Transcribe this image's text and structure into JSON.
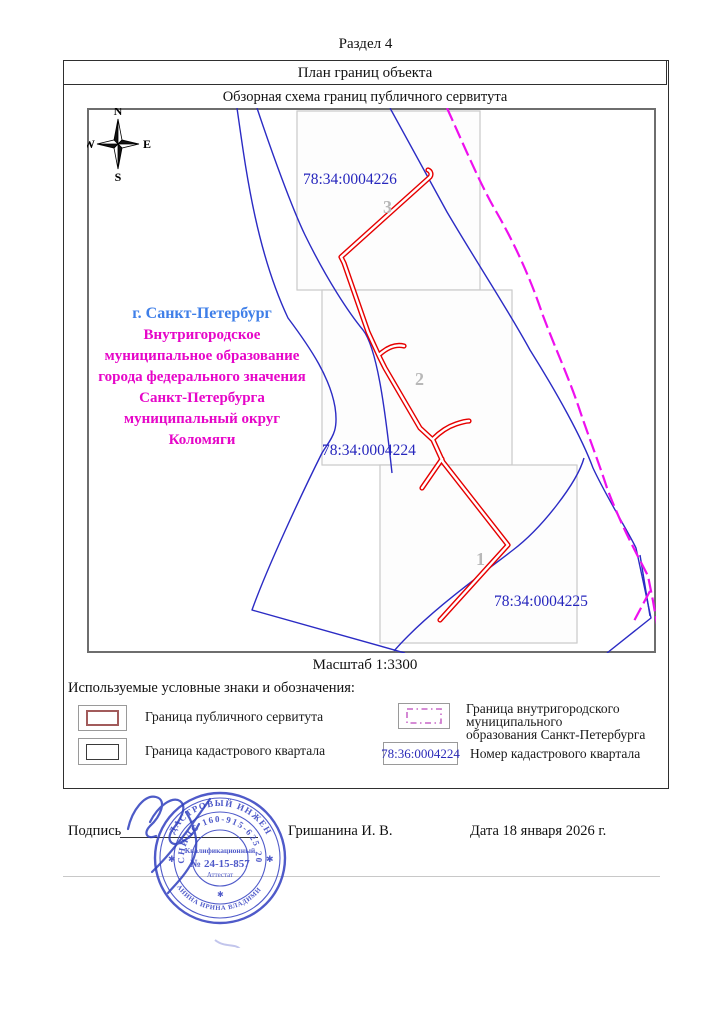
{
  "page": {
    "section_title": "Раздел 4",
    "table_header": "План границ объекта",
    "scheme_title": "Обзорная схема границ публичного сервитута",
    "scale_label": "Масштаб 1:3300"
  },
  "compass": {
    "n": "N",
    "s": "S",
    "e": "E",
    "w": "W"
  },
  "map": {
    "quarters": [
      {
        "number": "3",
        "cadastral_number": "78:34:0004226"
      },
      {
        "number": "2",
        "cadastral_number": "78:34:0004224"
      },
      {
        "number": "1",
        "cadastral_number": "78:34:0004225"
      }
    ],
    "city_label": "г. Санкт-Петербург",
    "municipality_lines": [
      "Внутригородское",
      "муниципальное образование",
      "города федерального значения",
      "Санкт-Петербурга",
      "муниципальный округ",
      "Коломяги"
    ],
    "colors": {
      "servitude_line": "#e60000",
      "cadastral_line": "#2b2bc4",
      "municipal_line": "#ee10ee",
      "quarter_border": "#c9c9c9",
      "city_label_color": "#3f7fe8",
      "municipality_color": "#e606c8",
      "cadastral_number_color": "#2626bd",
      "quarter_number_color": "#b8b8b8"
    }
  },
  "legend": {
    "heading": "Используемые условные знаки и обозначения:",
    "items": [
      {
        "label": "Граница публичного сервитута"
      },
      {
        "label": "Граница кадастрового квартала"
      },
      {
        "label_line1": "Граница внутригородского муниципального",
        "label_line2": "образования Санкт-Петербурга"
      },
      {
        "sample": "78:36:0004224",
        "label": "Номер кадастрового квартала"
      }
    ]
  },
  "footer": {
    "signature_label": "Подпись",
    "signer_name": "Гришанина И. В.",
    "date_label": "Дата 18 января 2026 г."
  },
  "stamp": {
    "outer_top": "КАДАСТРОВЫЙ ИНЖЕНЕР",
    "outer_bottom": "ГРИШАНИНА ИРИНА ВЛАДИМИРОВНА",
    "snils": "СНИЛС 160-915-625 20",
    "center_line1": "Квалификационный",
    "center_line2": "№ 24-15-857",
    "center_line3": "Аттестат",
    "color": "#3c49c4"
  }
}
